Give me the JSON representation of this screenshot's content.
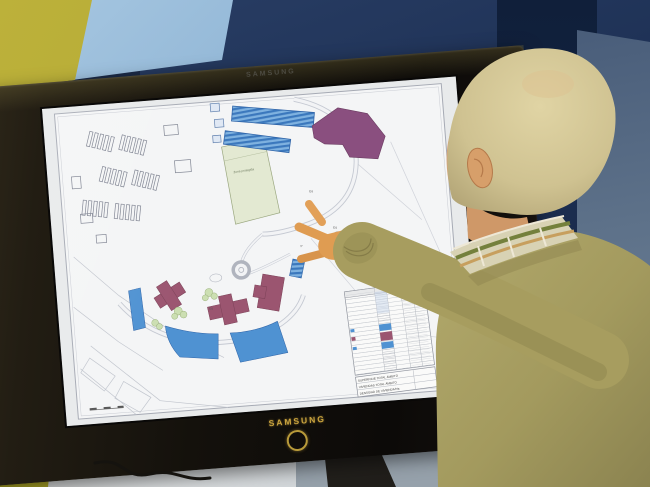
{
  "tv": {
    "brand_top": "SAMSUNG",
    "brand_bottom": "SAMSUNG"
  },
  "map": {
    "labels": {
      "protected_area": "Zona protegida",
      "eq_1": "Eq",
      "eq_2": "Eq",
      "eq_3": "Eq",
      "p_marker": "P"
    },
    "legend_summary": [
      "SUPERFICIE TOTAL ÁMBITO",
      "VIVIENDAS TOTAL ÁMBITO",
      "DENSIDAD DE VIVIENDA/Ha"
    ],
    "colors": {
      "residential_blue": "#4f92d2",
      "blue_stripe_light": "#7fb2e0",
      "blue_stripe_dark": "#3b78bd",
      "purple_building": "#8a4f7f",
      "maroon_building": "#9b5570",
      "protected_green": "#e3e9d2",
      "paper": "#f4f5f6"
    }
  },
  "background_colors": {
    "wall_yellow": "#b3a833",
    "panel_light_blue": "#7fa8cc",
    "wall_navy": "#1d3054",
    "wall_gray_blue": "#5d7189"
  }
}
